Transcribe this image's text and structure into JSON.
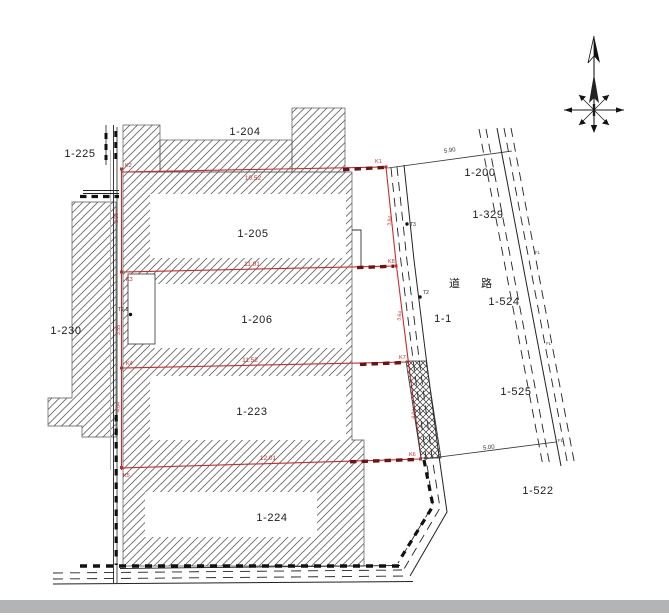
{
  "map": {
    "title": "cadastral-parcel-map",
    "road_label": "道 路",
    "parcels": [
      {
        "label": "1-204"
      },
      {
        "label": "1-225"
      },
      {
        "label": "1-205"
      },
      {
        "label": "1-230"
      },
      {
        "label": "1-206"
      },
      {
        "label": "1-223"
      },
      {
        "label": "1-224"
      },
      {
        "label": "1-200"
      },
      {
        "label": "1-329"
      },
      {
        "label": "1-524"
      },
      {
        "label": "1-525"
      },
      {
        "label": "1-522"
      },
      {
        "label": "1-1"
      }
    ],
    "boundary_dimensions": [
      {
        "v": "10.52"
      },
      {
        "v": "11.01"
      },
      {
        "v": "11.52"
      },
      {
        "v": "12.01"
      }
    ],
    "road_dimensions": [
      {
        "v": "5.90"
      },
      {
        "v": "5.00"
      }
    ],
    "edge_dimensions": [
      {
        "v": "3.96"
      },
      {
        "v": "3.55"
      },
      {
        "v": "4.04"
      },
      {
        "v": "3.84"
      },
      {
        "v": "3.64"
      },
      {
        "v": "4.04"
      }
    ],
    "points": [
      {
        "n": "K2"
      },
      {
        "n": "K1"
      },
      {
        "n": "K3"
      },
      {
        "n": "K4"
      },
      {
        "n": "K5"
      },
      {
        "n": "K8"
      },
      {
        "n": "K7"
      },
      {
        "n": "K6"
      },
      {
        "n": "T3"
      },
      {
        "n": "T2"
      },
      {
        "n": "T2-1"
      }
    ],
    "fl_marks": [
      {
        "v": "FL"
      },
      {
        "v": "FL"
      },
      {
        "v": "FL"
      }
    ],
    "colors": {
      "boundary_red": "#c03030",
      "confirmed_dash_red": "#6e1313",
      "ink": "#222222",
      "footer_bar": "#b3b4b6"
    }
  }
}
